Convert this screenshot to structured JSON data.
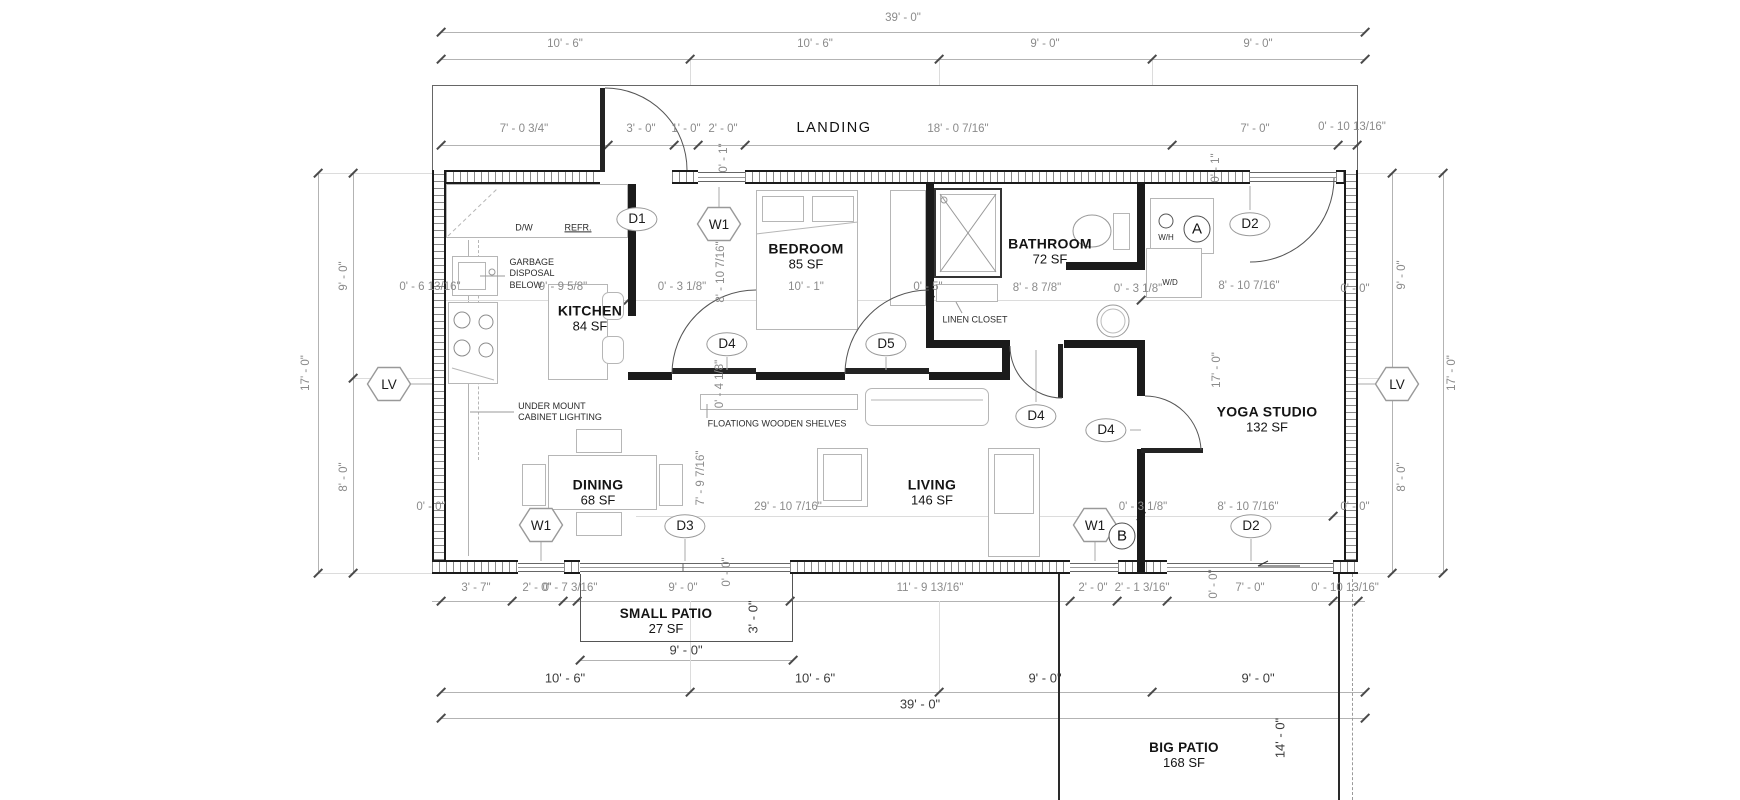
{
  "landing_label": "LANDING",
  "rooms": {
    "kitchen": {
      "name": "KITCHEN",
      "area": "84 SF"
    },
    "bedroom": {
      "name": "BEDROOM",
      "area": "85 SF"
    },
    "bathroom": {
      "name": "BATHROOM",
      "area": "72 SF"
    },
    "yoga": {
      "name": "YOGA STUDIO",
      "area": "132 SF"
    },
    "dining": {
      "name": "DINING",
      "area": "68 SF"
    },
    "living": {
      "name": "LIVING",
      "area": "146 SF"
    },
    "small_patio": {
      "name": "SMALL PATIO",
      "area": "27 SF"
    },
    "big_patio": {
      "name": "BIG PATIO",
      "area": "168 SF"
    }
  },
  "tags": {
    "d1": "D1",
    "d2": "D2",
    "d3": "D3",
    "d4": "D4",
    "d5": "D5",
    "w1": "W1",
    "lv": "LV",
    "a": "A",
    "b": "B"
  },
  "notes": {
    "dw": "D/W",
    "refr": "REFR.",
    "garbage": "GARBAGE\nDISPOSAL\nBELOW",
    "undermount": "UNDER MOUNT\nCABINET LIGHTING",
    "shelves": "FLOATIONG WOODEN SHELVES",
    "linen": "LINEN CLOSET",
    "wh": "W/H",
    "wd": "W/D"
  },
  "dims": {
    "d39": "39' - 0\"",
    "d10_6": "10' - 6\"",
    "d9_0": "9' - 0\"",
    "d17_0": "17' - 0\"",
    "d8_0": "8' - 0\"",
    "d3_0": "3' - 0\"",
    "d14_0": "14' - 0\"",
    "d7_0_34": "7' - 0 3/4\"",
    "d1_0": "1' - 0\"",
    "d2_0": "2' - 0\"",
    "d18_0_716": "18' - 0 7/16\"",
    "d7_0": "7' - 0\"",
    "d0_10_1316": "0' - 10 13/16\"",
    "d0_6_1316": "0' - 6 13/16\"",
    "d9_9_58": "9' - 9 5/8\"",
    "d0_3_18": "0' - 3 1/8\"",
    "d10_1": "10' - 1\"",
    "d0_5": "0' - 5\"",
    "d8_8_78": "8' - 8 7/8\"",
    "d8_10_716": "8' - 10 7/16\"",
    "d0_0": "0' - 0\"",
    "d0_1": "0' - 1\"",
    "d0_4_18": "0' - 4 1/8\"",
    "d7_9_716": "7' - 9 7/16\"",
    "d29_10_716": "29' - 10 7/16\"",
    "d3_7": "3' - 7\"",
    "d0_7_316": "0' - 7 3/16\"",
    "d11_9_1316": "11' - 9 13/16\"",
    "d2_1_316": "2' - 1 3/16\""
  }
}
